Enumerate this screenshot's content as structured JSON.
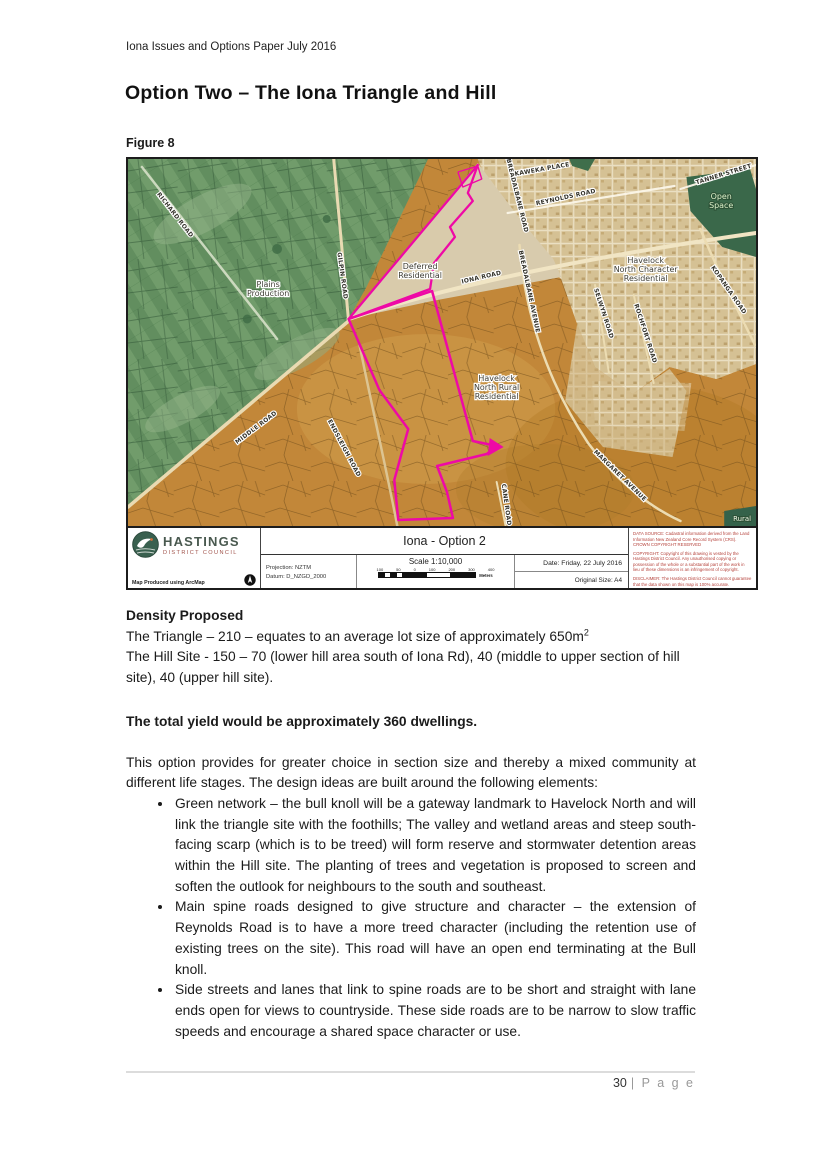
{
  "page": {
    "header": "Iona Issues and Options Paper July 2016",
    "title": "Option Two – The Iona Triangle and Hill",
    "figure_label": "Figure 8",
    "footer_page_number": "30",
    "footer_page_word": "| P a g e"
  },
  "density": {
    "heading": "Density Proposed",
    "triangle_line": "The Triangle – 210 – equates to an average lot size of approximately 650m",
    "triangle_sup": "2",
    "hill_line": "The Hill Site - 150 – 70 (lower hill area south of Iona Rd), 40 (middle to upper section of hill site), 40 (upper hill site).",
    "total_yield": "The total yield would be approximately 360 dwellings.",
    "intro": "This option provides for greater choice in section size and thereby a mixed community at different life stages.  The design ideas are built around the following elements:",
    "bullets": [
      "Green network – the bull knoll will be a gateway landmark to Havelock North and will link the triangle site with the foothills;  The valley and wetland areas and steep south-facing scarp (which is to be treed) will form reserve and stormwater detention areas within the Hill site.  The planting of trees and vegetation is proposed to screen and soften the outlook for neighbours to the south and southeast.",
      "Main spine roads designed to give structure and character – the extension of Reynolds Road is to have a more treed character (including the retention use of existing trees on the site).  This road will have an open end terminating at the Bull knoll.",
      "Side streets and lanes that link to spine roads are to be short and straight with lane ends open for views to countryside.  These side roads are to be narrow to slow traffic speeds and encourage a shared space character or use."
    ]
  },
  "map": {
    "colors": {
      "site_outline_magenta": "#ee09a6",
      "farmland_green": "#628e5f",
      "rural_orange": "#c28739",
      "urban_beige": "#d7c398",
      "open_space_green": "#3a684a",
      "notes_red": "#b5413a"
    },
    "zone_labels": [
      {
        "lines": [
          "Plains",
          "Production"
        ],
        "x": 141,
        "y": 128,
        "cls": "zone"
      },
      {
        "lines": [
          "Deferred",
          "Residential"
        ],
        "x": 294,
        "y": 110,
        "cls": "zone"
      },
      {
        "lines": [
          "Havelock",
          "North Character",
          "Residential"
        ],
        "x": 521,
        "y": 104,
        "cls": "zone"
      },
      {
        "lines": [
          "Havelock",
          "North Rural",
          "Residential"
        ],
        "x": 371,
        "y": 222,
        "cls": "zone"
      },
      {
        "lines": [
          "Open",
          "Space"
        ],
        "x": 597,
        "y": 40,
        "cls": "zone-green"
      },
      {
        "lines": [
          "Rural"
        ],
        "x": 618,
        "y": 362,
        "cls": "zone-light"
      }
    ],
    "road_labels": [
      {
        "t": "RICHARD ROAD",
        "x": 46,
        "y": 57,
        "r": 52
      },
      {
        "t": "GILPIN ROAD",
        "x": 214,
        "y": 117,
        "r": 82
      },
      {
        "t": "MIDDLE ROAD",
        "x": 130,
        "y": 270,
        "r": -37
      },
      {
        "t": "ENDSLEIGH ROAD",
        "x": 216,
        "y": 290,
        "r": 62
      },
      {
        "t": "IONA ROAD",
        "x": 356,
        "y": 120,
        "r": -13
      },
      {
        "t": "BREADALBANE ROAD",
        "x": 390,
        "y": 37,
        "r": 76
      },
      {
        "t": "KAWEKA PLACE",
        "x": 417,
        "y": 12,
        "r": -10
      },
      {
        "t": "REYNOLDS ROAD",
        "x": 441,
        "y": 40,
        "r": -12
      },
      {
        "t": "TANNER STREET",
        "x": 600,
        "y": 17,
        "r": -17
      },
      {
        "t": "BREADALBANE AVENUE",
        "x": 402,
        "y": 133,
        "r": 78
      },
      {
        "t": "SELWYN ROAD",
        "x": 477,
        "y": 155,
        "r": 72
      },
      {
        "t": "ROCHFORT ROAD",
        "x": 519,
        "y": 175,
        "r": 72
      },
      {
        "t": "KOPANGA ROAD",
        "x": 603,
        "y": 132,
        "r": 55
      },
      {
        "t": "MARGARET AVENUE",
        "x": 494,
        "y": 318,
        "r": 44
      },
      {
        "t": "CANE ROAD",
        "x": 379,
        "y": 346,
        "r": 82
      }
    ],
    "legend": {
      "org_name": "HASTINGS",
      "org_sub": "DISTRICT COUNCIL",
      "produced": "Map Produced using ArcMap",
      "projection": "Projection: NZTM",
      "datum": "Datum: D_NZGD_2000",
      "map_title": "Iona - Option 2",
      "scale_label": "Scale 1:10,000",
      "scale_ticks": [
        "100",
        "50",
        "0",
        "100",
        "200",
        "300",
        "400"
      ],
      "scale_unit": "Meters",
      "date_label": "Date: Friday, 22 July 2016",
      "size_label": "Original Size: A4",
      "notes": [
        "DATA SOURCE: Cadastral information derived from the Land Information New Zealand Core Record System (CRS). CROWN COPYRIGHT RESERVED",
        "COPYRIGHT: Copyright of this drawing is vested by the Hastings District Council. Any unauthorised copying or possession of the whole or a substantial part of the work in lieu of these dimensions is an infringement of copyright.",
        "DISCLAIMER: The Hastings District Council cannot guarantee that the data shown on this map is 100% accurate."
      ]
    }
  }
}
